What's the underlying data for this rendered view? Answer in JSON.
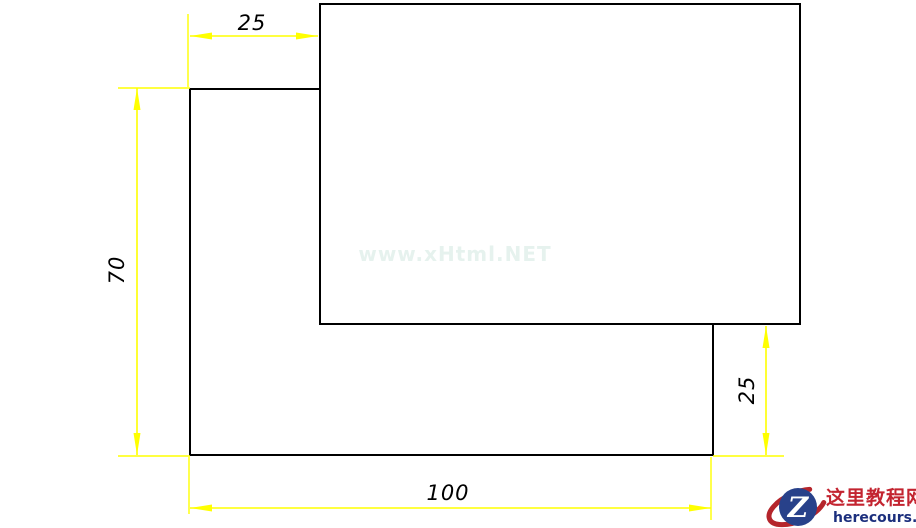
{
  "drawing": {
    "type": "cad-dimensioned-sketch",
    "dimensions": {
      "top_width": {
        "label": "25"
      },
      "left_height": {
        "label": "70"
      },
      "right_height": {
        "label": "25"
      },
      "bottom_width": {
        "label": "100"
      }
    },
    "watermark": {
      "text": "www.xHtml.NET"
    }
  },
  "branding": {
    "logo_letter": "Z",
    "site_name": "这里教程网",
    "site_url": "herecours.com"
  },
  "colors": {
    "dimension_yellow": "#ffff00",
    "outline_black": "#000000",
    "background": "#ffffff",
    "logo_red": "#c32430",
    "logo_navy": "#1c2f7d",
    "logo_circle_blue": "#28418a",
    "watermark_tint": "#e6f2ee"
  }
}
